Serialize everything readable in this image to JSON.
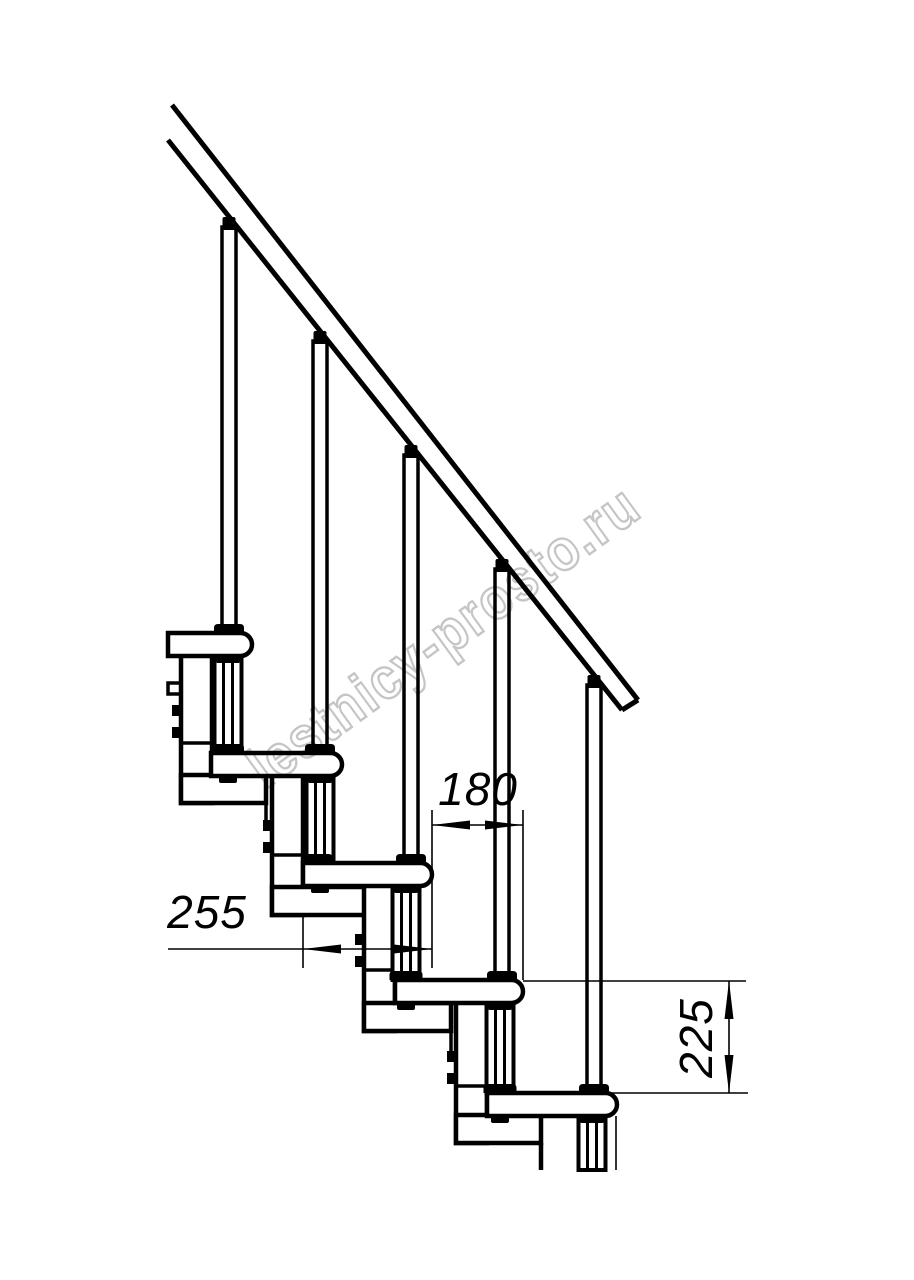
{
  "colors": {
    "line": "#000000",
    "background": "#ffffff",
    "watermark": "#c5c5c5"
  },
  "watermark": {
    "text": "lestnicy-prosto.ru"
  },
  "dimensions": {
    "tread_length_label": "255",
    "step_run_label": "180",
    "step_rise_label": "225"
  }
}
